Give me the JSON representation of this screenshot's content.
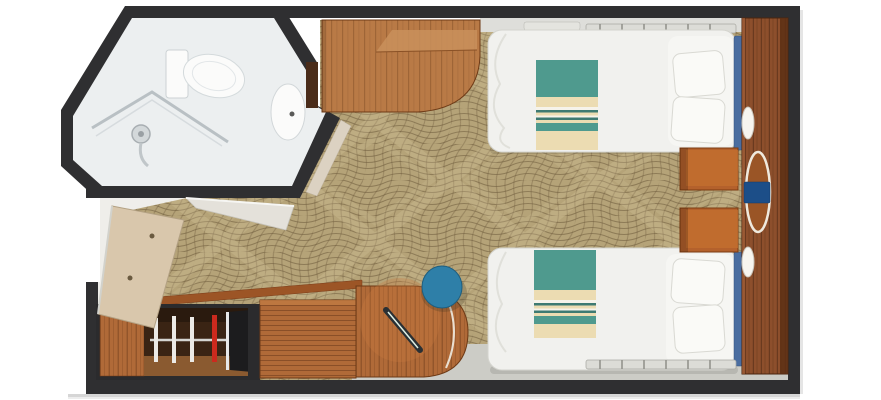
{
  "scene": {
    "type": "floorplan",
    "subject": "twin-bed stateroom with bathroom, wardrobe and vanity"
  },
  "palette": {
    "page_bg": "#ffffff",
    "wall": "#2f2f31",
    "bathroom_floor": "#ecefF0",
    "fixture_white": "#fbfbfa",
    "carpet_base": "#b5a378",
    "carpet_line": "#6d5a3c",
    "carpet_light": "#d9caa0",
    "floor_gray": "#ccccc6",
    "floor_light": "#dededa",
    "wood": "#b06a38",
    "wood_desk": "#b97a46",
    "wood_panel": "#8d4f2c",
    "wood_dark": "#6e3a16",
    "nightstand": "#b4612c",
    "bed_white": "#f1f1ee",
    "pillow_white": "#fafaf7",
    "headboard_blue": "#4a6da0",
    "blanket_teal": "#4f9a8e",
    "blanket_teal_dark": "#3e7a72",
    "blanket_cream": "#ecdcb2",
    "blanket_white": "#f6f3ea",
    "stool_blue": "#2e7fa8",
    "chair_blue": "#1c4e88",
    "door_beige": "#d9c7ac",
    "closet_interior": "#3a2414",
    "closet_floor": "#8a5a30",
    "hanger_red": "#cc2a1e",
    "metal": "#c9ced1"
  },
  "items": [
    {
      "id": "bathroom",
      "label": "bathroom"
    },
    {
      "id": "toilet",
      "label": "toilet"
    },
    {
      "id": "shower",
      "label": "shower"
    },
    {
      "id": "sink",
      "label": "sink"
    },
    {
      "id": "entry-door",
      "label": "entry door"
    },
    {
      "id": "bathroom-door",
      "label": "bathroom door"
    },
    {
      "id": "wardrobe-closet",
      "label": "wardrobe closet"
    },
    {
      "id": "dresser",
      "label": "dresser"
    },
    {
      "id": "corner-cabinet",
      "label": "curved corner cabinet"
    },
    {
      "id": "desk-cabinet",
      "label": "desk cabinet"
    },
    {
      "id": "twin-bed-upper",
      "label": "twin bed"
    },
    {
      "id": "twin-bed-lower",
      "label": "twin bed"
    },
    {
      "id": "nightstand",
      "label": "nightstand"
    },
    {
      "id": "vanity-panel",
      "label": "vanity wall panel"
    },
    {
      "id": "vanity-table",
      "label": "oval table with chair"
    },
    {
      "id": "stool",
      "label": "round stool"
    },
    {
      "id": "carpet",
      "label": "patterned carpet"
    }
  ]
}
